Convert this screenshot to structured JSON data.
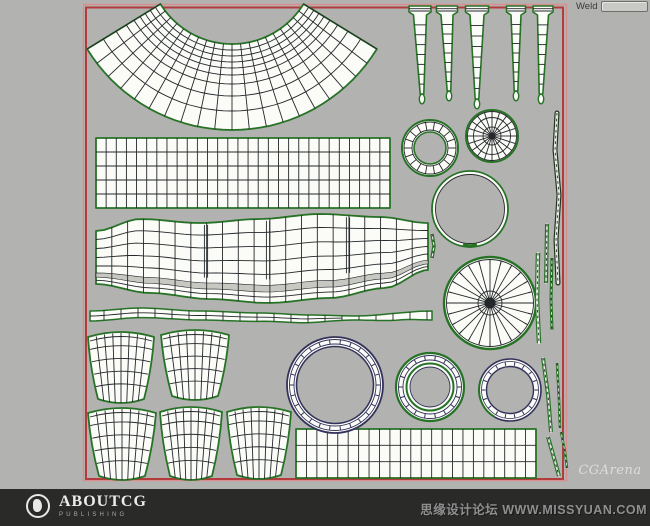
{
  "toolbar": {
    "weld_label": "Weld",
    "weld_field_value": ""
  },
  "watermarks": {
    "cgarena": "CGArena",
    "forum": "思缘设计论坛 WWW.MISSYUAN.COM"
  },
  "footer": {
    "brand": "ABOUTCG",
    "brand_sub": "PUBLISHING"
  },
  "icons": {
    "logo": "aboutcg-circle-logo"
  },
  "colors": {
    "canvas_bg": "#b2b2b0",
    "selection_red": "#b23c3c",
    "selection_red_light": "#d98f8f",
    "shell_green": "#267326",
    "wire_dark": "#24282a",
    "navy": "#32325a",
    "shell_fill": "#fbfbf8",
    "footer_bg": "#2a2a28",
    "field_bg": "#c9c9c5",
    "text_dark": "#3a3a3a",
    "watermark_gray": "#8f8f8f"
  }
}
